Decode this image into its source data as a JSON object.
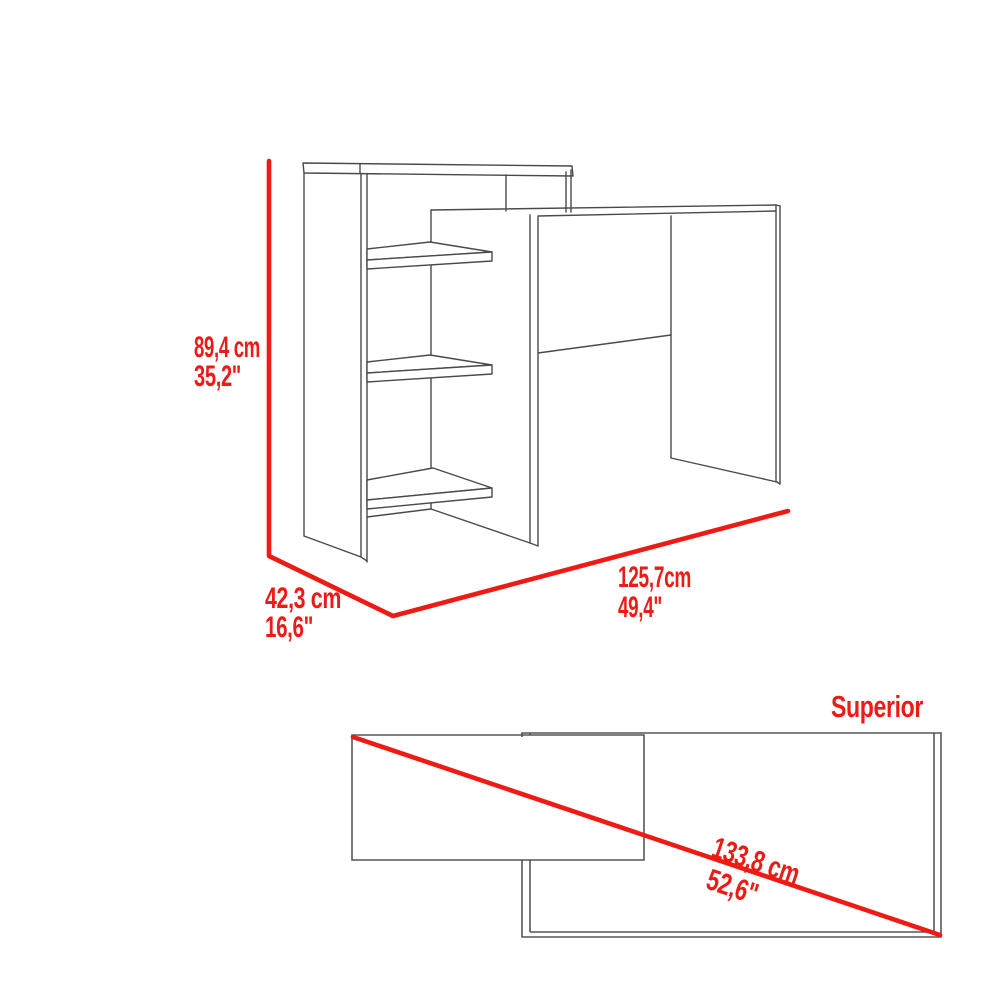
{
  "title": "Desk with side bookcase dimension diagram",
  "colors": {
    "accent_red": "#ED1B16",
    "line_gray": "#4A4A4A"
  },
  "front_view": {
    "height": {
      "cm": "89,4 cm",
      "inches": "35,2\""
    },
    "depth": {
      "cm": "42,3 cm",
      "inches": "16,6\""
    },
    "width": {
      "cm": "125,7cm",
      "inches": "49,4\""
    }
  },
  "top_view": {
    "label": "Superior",
    "diagonal": {
      "cm": "133,8 cm",
      "inches": "52,6\""
    }
  }
}
